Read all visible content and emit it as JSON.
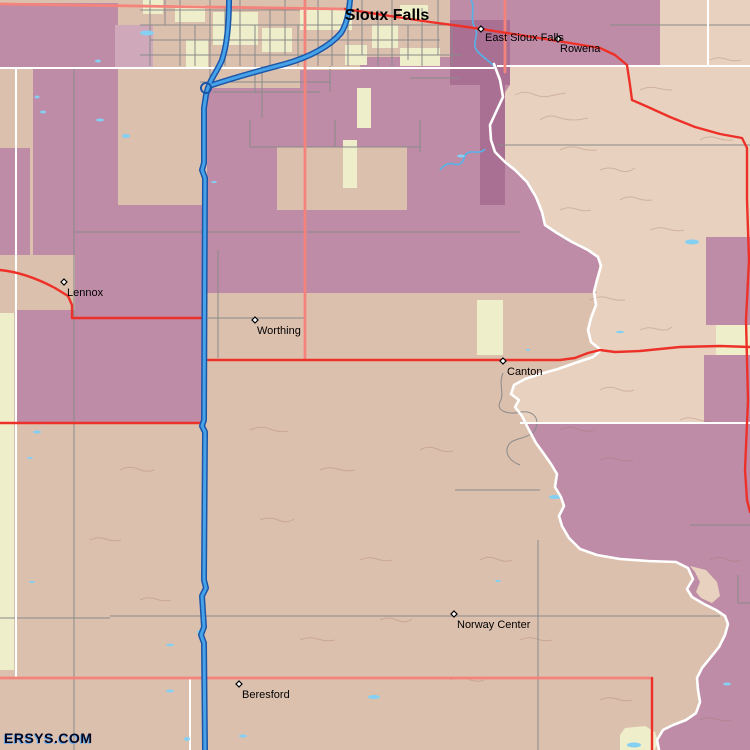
{
  "watermark": "ERSYS.COM",
  "places": [
    {
      "name": "Sioux Falls",
      "type": "city-major"
    },
    {
      "name": "East Sioux Falls",
      "type": "town"
    },
    {
      "name": "Rowena",
      "type": "town"
    },
    {
      "name": "Lennox",
      "type": "town"
    },
    {
      "name": "Worthing",
      "type": "town"
    },
    {
      "name": "Canton",
      "type": "town"
    },
    {
      "name": "Norway Center",
      "type": "town"
    },
    {
      "name": "Beresford",
      "type": "town"
    }
  ],
  "palette": {
    "land_sd": "#dcc0ae",
    "land_iowa": "#e8d2bf",
    "census_mauve": "#be8ca7",
    "census_mauve_dark": "#a97094",
    "census_mauve_light": "#cfa9b9",
    "urban_yellow": "#eeeeca",
    "highway_red": "#ee3128",
    "road_coral": "#f4837b",
    "road_gray": "#8a8a8a",
    "boundary_white": "#ffffff",
    "interstate_blue": "#47a3e9",
    "interstate_casing": "#1b56a7",
    "water_blue": "#83d0f2"
  }
}
